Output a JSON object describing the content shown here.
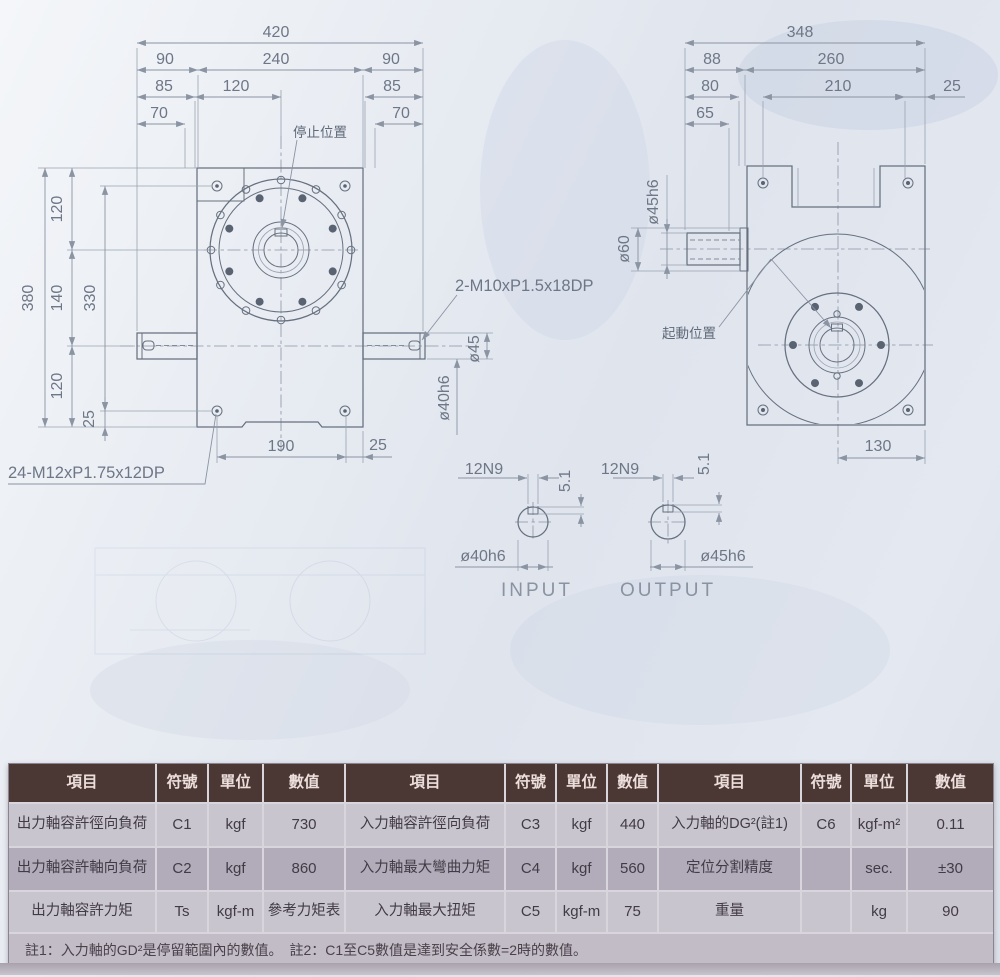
{
  "drawing": {
    "front_view": {
      "w420": "420",
      "w90l": "90",
      "w240": "240",
      "w90r": "90",
      "w85l": "85",
      "w120t": "120",
      "w85r": "85",
      "w70l": "70",
      "w70r": "70",
      "stop_label": "停止位置",
      "h120a": "120",
      "h380": "380",
      "h140": "140",
      "h330": "330",
      "h120b": "120",
      "h25s": "25",
      "w190": "190",
      "w25b": "25",
      "tap24": "24-M12xP1.75x12DP",
      "tap2": "2-M10xP1.5x18DP",
      "dia45": "ø45",
      "dia40": "ø40h6"
    },
    "side_view": {
      "w348": "348",
      "w88": "88",
      "w260": "260",
      "w80": "80",
      "w210": "210",
      "w25": "25",
      "w65": "65",
      "dia45h6": "ø45h6",
      "dia60": "ø60",
      "start_label": "起動位置",
      "w130": "130"
    },
    "input_section": {
      "key": "12N9",
      "depth": "5.1",
      "dia": "ø40h6",
      "caption": "INPUT"
    },
    "output_section": {
      "key": "12N9",
      "depth": "5.1",
      "dia": "ø45h6",
      "caption": "OUTPUT"
    }
  },
  "table": {
    "headers": [
      "項目",
      "符號",
      "單位",
      "數值",
      "項目",
      "符號",
      "單位",
      "數值",
      "項目",
      "符號",
      "單位",
      "數值"
    ],
    "rows": [
      [
        "出力軸容許徑向負荷",
        "C1",
        "kgf",
        "730",
        "入力軸容許徑向負荷",
        "C3",
        "kgf",
        "440",
        "入力軸的DG²(註1)",
        "C6",
        "kgf-m²",
        "0.11"
      ],
      [
        "出力軸容許軸向負荷",
        "C2",
        "kgf",
        "860",
        "入力軸最大彎曲力矩",
        "C4",
        "kgf",
        "560",
        "定位分割精度",
        "",
        "sec.",
        "±30"
      ],
      [
        "出力軸容許力矩",
        "Ts",
        "kgf-m",
        "參考力矩表",
        "入力軸最大扭矩",
        "C5",
        "kgf-m",
        "75",
        "重量",
        "",
        "kg",
        "90"
      ]
    ],
    "note": "註1：入力軸的GD²是停留範圍內的數值。　註2：C1至C5數值是達到安全係數=2時的數值。"
  },
  "colors": {
    "header_bg": "#4b3734",
    "row_light": "#c9c5ce",
    "row_dark": "#b2acba",
    "line": "#67707f",
    "paper": "#e4e8f0"
  }
}
